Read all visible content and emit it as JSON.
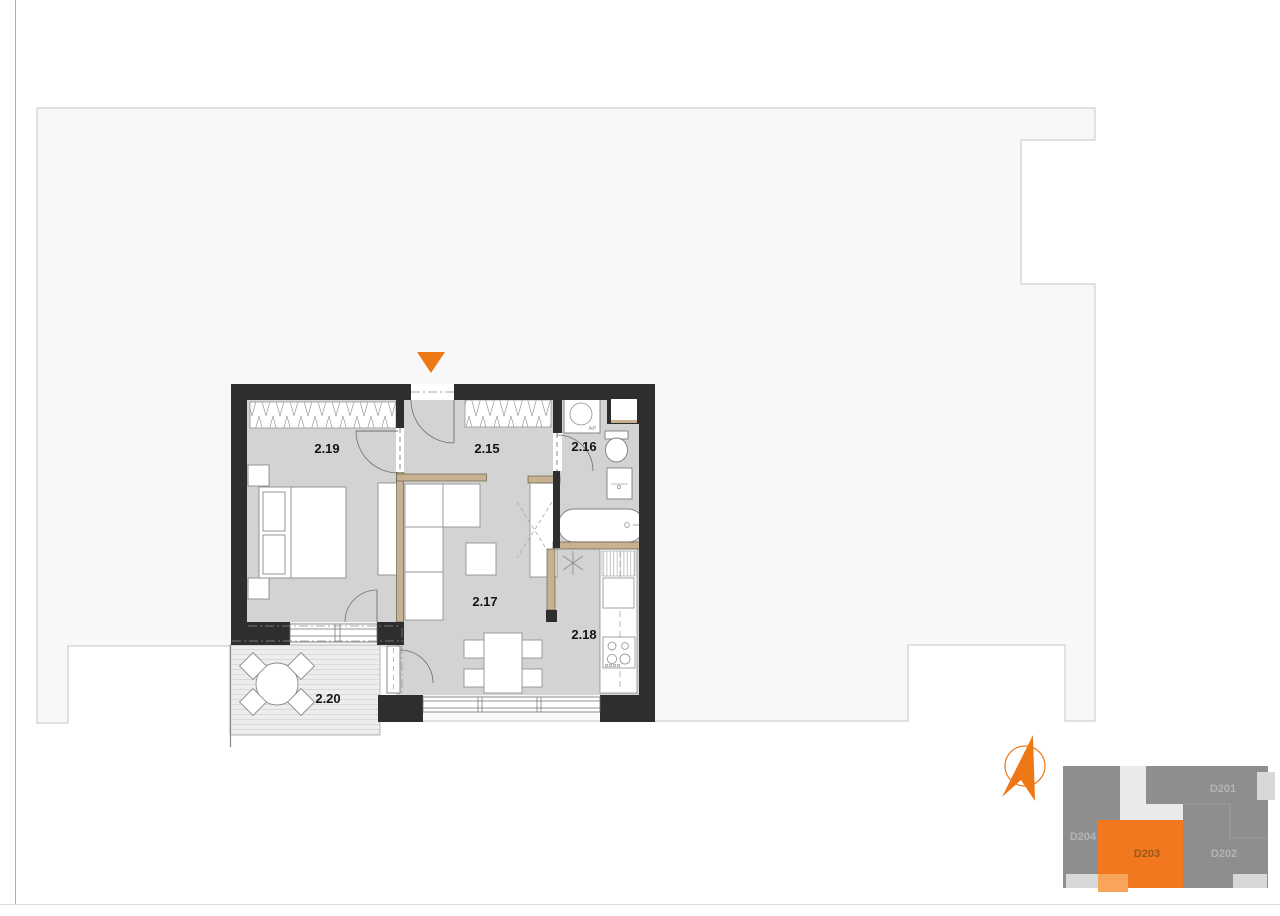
{
  "plan": {
    "rooms": [
      {
        "label": "2.19",
        "name": "bedroom"
      },
      {
        "label": "2.15",
        "name": "hallway"
      },
      {
        "label": "2.16",
        "name": "bathroom"
      },
      {
        "label": "2.17",
        "name": "living-room"
      },
      {
        "label": "2.18",
        "name": "kitchen"
      },
      {
        "label": "2.20",
        "name": "terrace"
      }
    ],
    "annotations": {
      "washing_machine": "AP"
    },
    "colors": {
      "accent_orange": "#ef7816",
      "exterior_wall": "#2e2e2e",
      "partition_wall": "#c8b190",
      "room_floor": "#d3d3d3",
      "building_outline_fill": "#f8f8f8",
      "terrace_deck": "#ededed"
    }
  },
  "north_arrow": {
    "color": "#ef7816"
  },
  "keyplan": {
    "units": [
      {
        "label": "D201",
        "highlighted": false
      },
      {
        "label": "D202",
        "highlighted": false
      },
      {
        "label": "D203",
        "highlighted": true
      },
      {
        "label": "D204",
        "highlighted": false
      }
    ],
    "colors": {
      "base": "#8e8e8e",
      "highlight": "#f1781e",
      "highlight_balcony": "#f8a45b",
      "balcony": "#d8d8d8",
      "label": "#b4b4b4",
      "highlight_label": "#9c561c"
    }
  }
}
